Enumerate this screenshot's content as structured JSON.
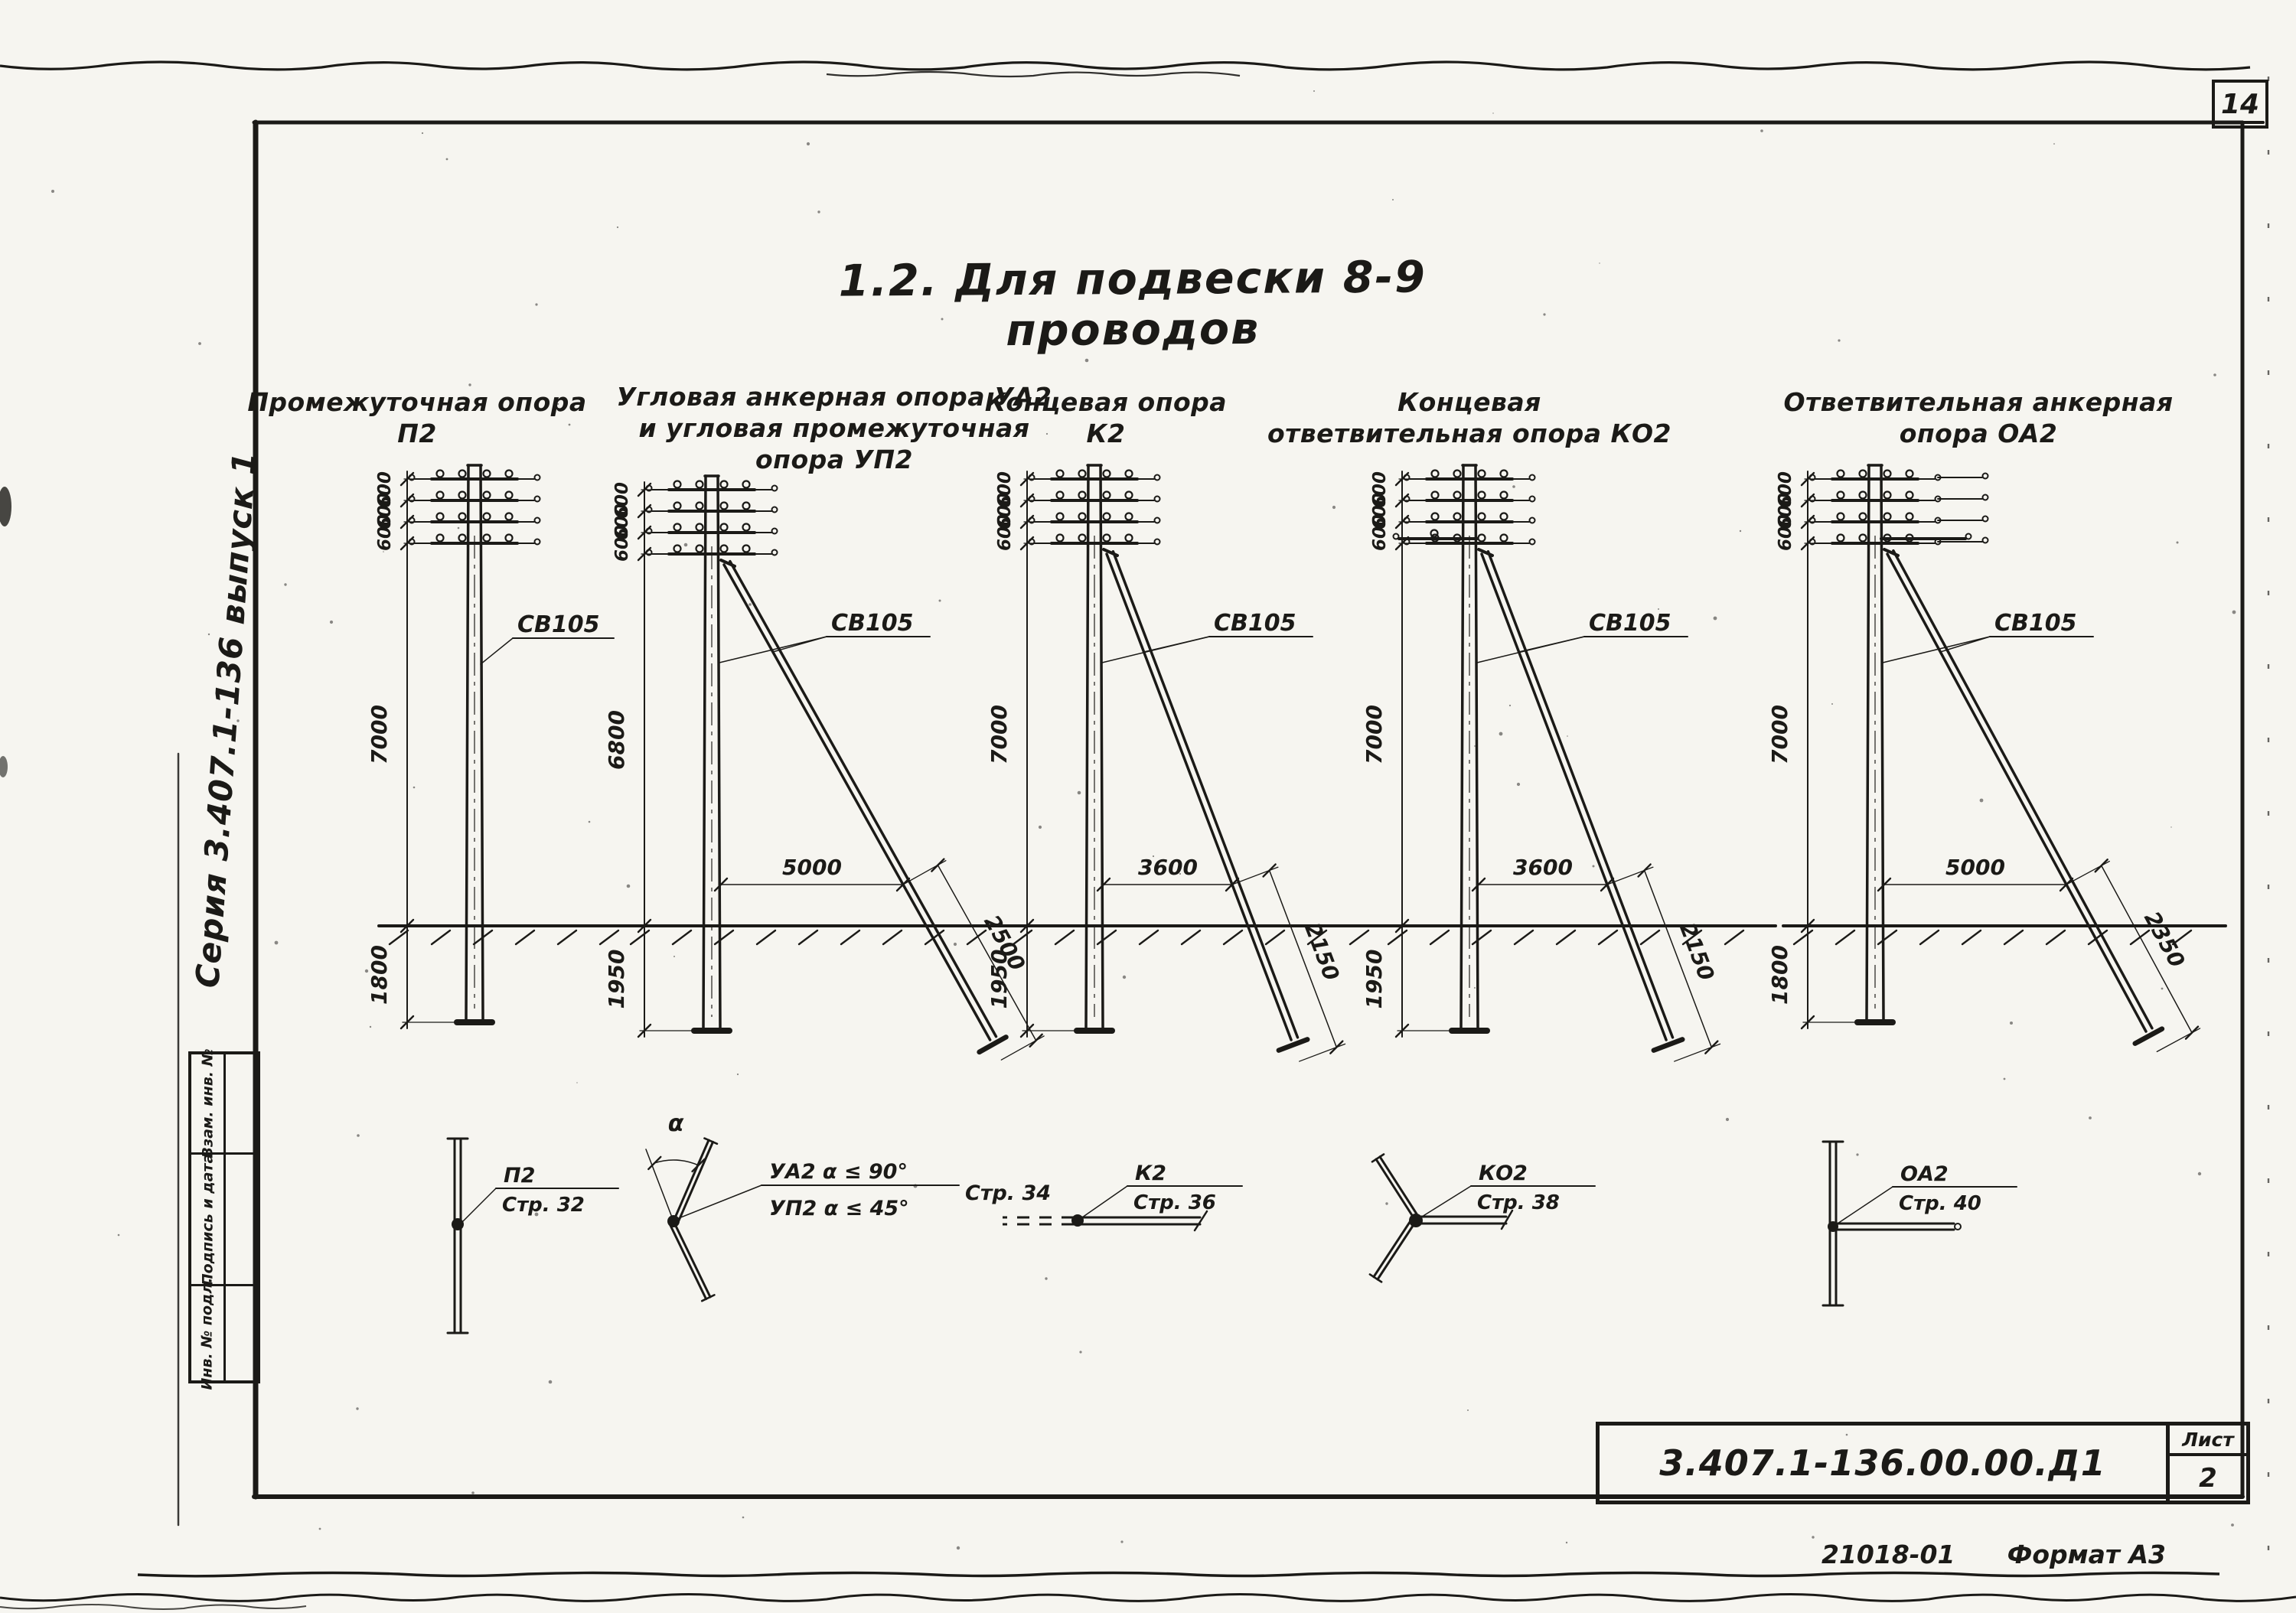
{
  "sheet": {
    "page_number": "14",
    "series_note": "Серия 3.407.1-136 выпуск 1",
    "order_number": "21018-01",
    "format_note": "Формат А3",
    "title": "1.2. Для подвески 8-9 проводов"
  },
  "stamp_column": {
    "cells": [
      {
        "label": "Взам. инв. №"
      },
      {
        "label": "Подпись и дата"
      },
      {
        "label": "Инв. № подл."
      }
    ]
  },
  "title_block": {
    "doc_number": "3.407.1-136.00.00.Д1",
    "sheet_label": "Лист",
    "sheet_value": "2"
  },
  "poles": [
    {
      "id": "p2",
      "title_lines": [
        "Промежуточная опора",
        "П2"
      ],
      "pole_mark": "СВ105",
      "crossarm_spacings": [
        "600",
        "600",
        "600"
      ],
      "height_above": "7000",
      "depth_below": "1800",
      "strut": null,
      "plan_symbol": {
        "type": "intermediate",
        "code": "П2",
        "page_ref": "Стр. 32"
      }
    },
    {
      "id": "ua2-up2",
      "title_lines": [
        "Угловая анкерная опора УА2",
        "и угловая промежуточная",
        "опора УП2"
      ],
      "pole_mark": "СВ105",
      "crossarm_spacings": [
        "600",
        "600",
        "600"
      ],
      "height_above": "6800",
      "depth_below": "1950",
      "strut": {
        "offset_horizontal": "5000",
        "extension": "2500"
      },
      "plan_symbol": {
        "type": "angle",
        "code": "УА2",
        "page_ref": "Стр. 34",
        "angle_label": "α",
        "conditions": [
          "УА2  α ≤ 90°",
          "УП2  α ≤ 45°"
        ]
      }
    },
    {
      "id": "k2",
      "title_lines": [
        "Концевая опора",
        "К2"
      ],
      "pole_mark": "СВ105",
      "crossarm_spacings": [
        "600",
        "600",
        "600"
      ],
      "height_above": "7000",
      "depth_below": "1950",
      "strut": {
        "offset_horizontal": "3600",
        "extension": "2150"
      },
      "plan_symbol": {
        "type": "end",
        "code": "К2",
        "page_ref": "Стр. 36"
      }
    },
    {
      "id": "ko2",
      "title_lines": [
        "Концевая",
        "ответвительная опора КО2"
      ],
      "pole_mark": "СВ105",
      "crossarm_spacings": [
        "600",
        "600",
        "600"
      ],
      "height_above": "7000",
      "depth_below": "1950",
      "strut": {
        "offset_horizontal": "3600",
        "extension": "2150"
      },
      "plan_symbol": {
        "type": "branch-end",
        "code": "КО2",
        "page_ref": "Стр. 38"
      }
    },
    {
      "id": "oa2",
      "title_lines": [
        "Ответвительная  анкерная",
        "опора ОА2"
      ],
      "pole_mark": "СВ105",
      "crossarm_spacings": [
        "600",
        "600",
        "600"
      ],
      "height_above": "7000",
      "depth_below": "1800",
      "strut": {
        "offset_horizontal": "5000",
        "extension": "2350"
      },
      "plan_symbol": {
        "type": "branch-anchor",
        "code": "ОА2",
        "page_ref": "Стр. 40"
      }
    }
  ]
}
